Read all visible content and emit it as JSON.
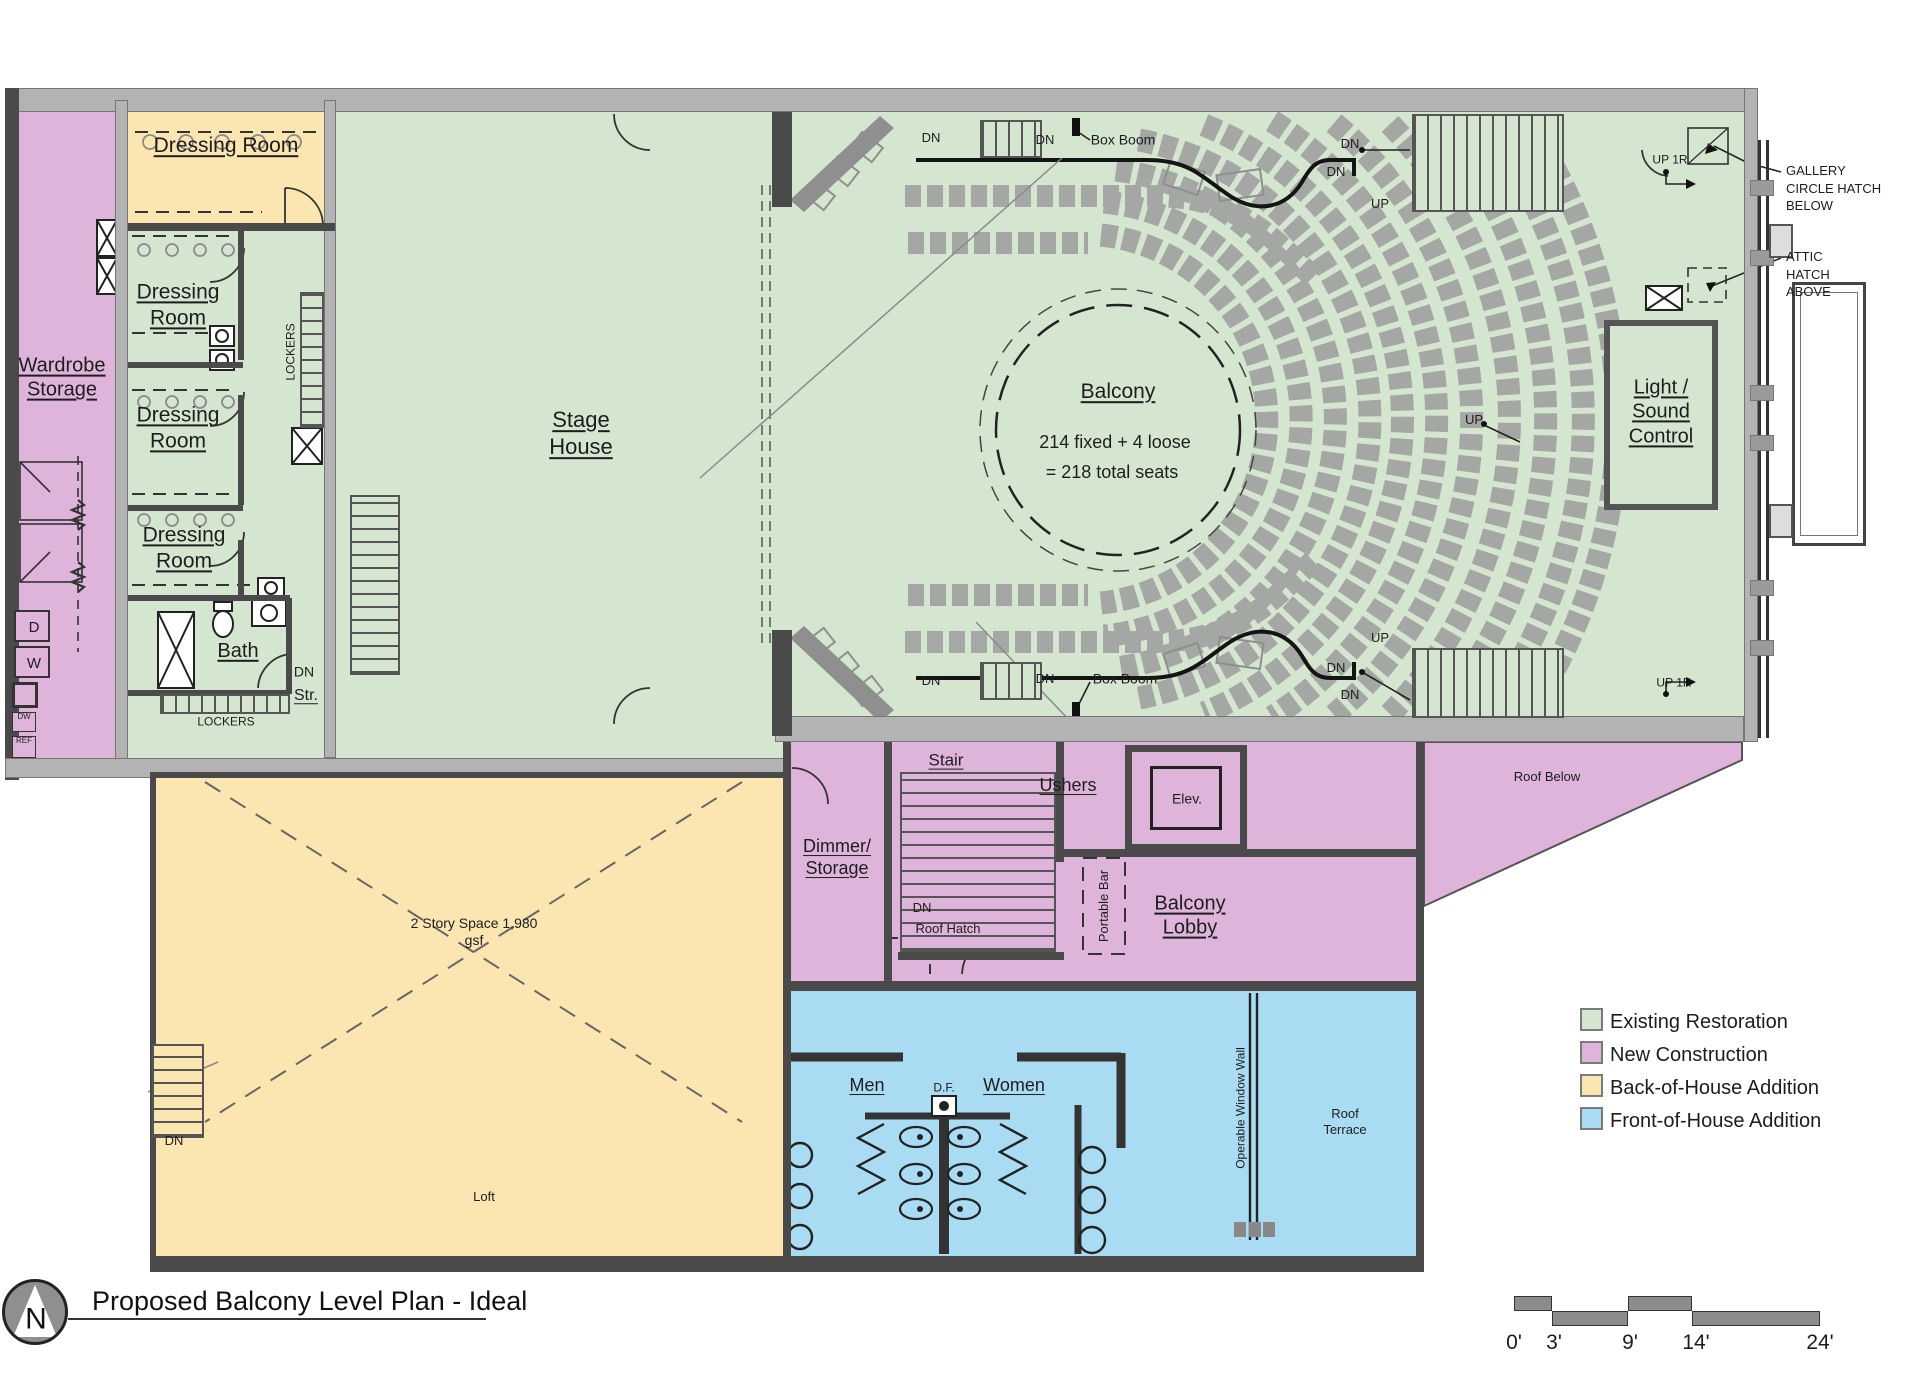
{
  "title": {
    "text": "Proposed Balcony Level Plan - Ideal",
    "north": "N"
  },
  "legend": {
    "items": [
      {
        "label": "Existing Restoration",
        "color": "#d5e6d0"
      },
      {
        "label": "New Construction",
        "color": "#dfb4da"
      },
      {
        "label": "Back-of-House Addition",
        "color": "#fbe5b1"
      },
      {
        "label": "Front-of-House Addition",
        "color": "#a9dbf2"
      }
    ]
  },
  "scalebar": {
    "t0": "0'",
    "t1": "3'",
    "t2": "9'",
    "t3": "14'",
    "t4": "24'"
  },
  "markers": {
    "dn": "DN",
    "up": "UP",
    "up1r": "UP 1R",
    "box_boom": "Box Boom"
  },
  "rooms": {
    "wardrobe": "Wardrobe Storage",
    "dressing": "Dressing Room",
    "bath": "Bath",
    "str": "Str.",
    "lockers": "LOCKERS",
    "stage_house": "Stage House",
    "balcony": "Balcony",
    "balcony_note1": "214 fixed + 4 loose",
    "balcony_note2": "= 218 total seats",
    "light_sound": "Light / Sound Control",
    "stair": "Stair",
    "ushers": "Ushers",
    "elev": "Elev.",
    "dimmer": "Dimmer/ Storage",
    "lobby": "Balcony Lobby",
    "portable_bar": "Portable Bar",
    "roof_hatch": "Roof Hatch",
    "roof_below": "Roof Below",
    "men": "Men",
    "women": "Women",
    "df": "D.F.",
    "window_wall": "Operable Window Wall",
    "roof_terrace": "Roof Terrace",
    "loft": "Loft",
    "two_story": "2 Story Space 1,980 gsf"
  },
  "annotations": {
    "gallery": "GALLERY CIRCLE HATCH BELOW",
    "attic": "ATTIC HATCH ABOVE"
  },
  "appliances": {
    "d": "D",
    "w": "W",
    "dw": "DW",
    "ref": "REF"
  }
}
